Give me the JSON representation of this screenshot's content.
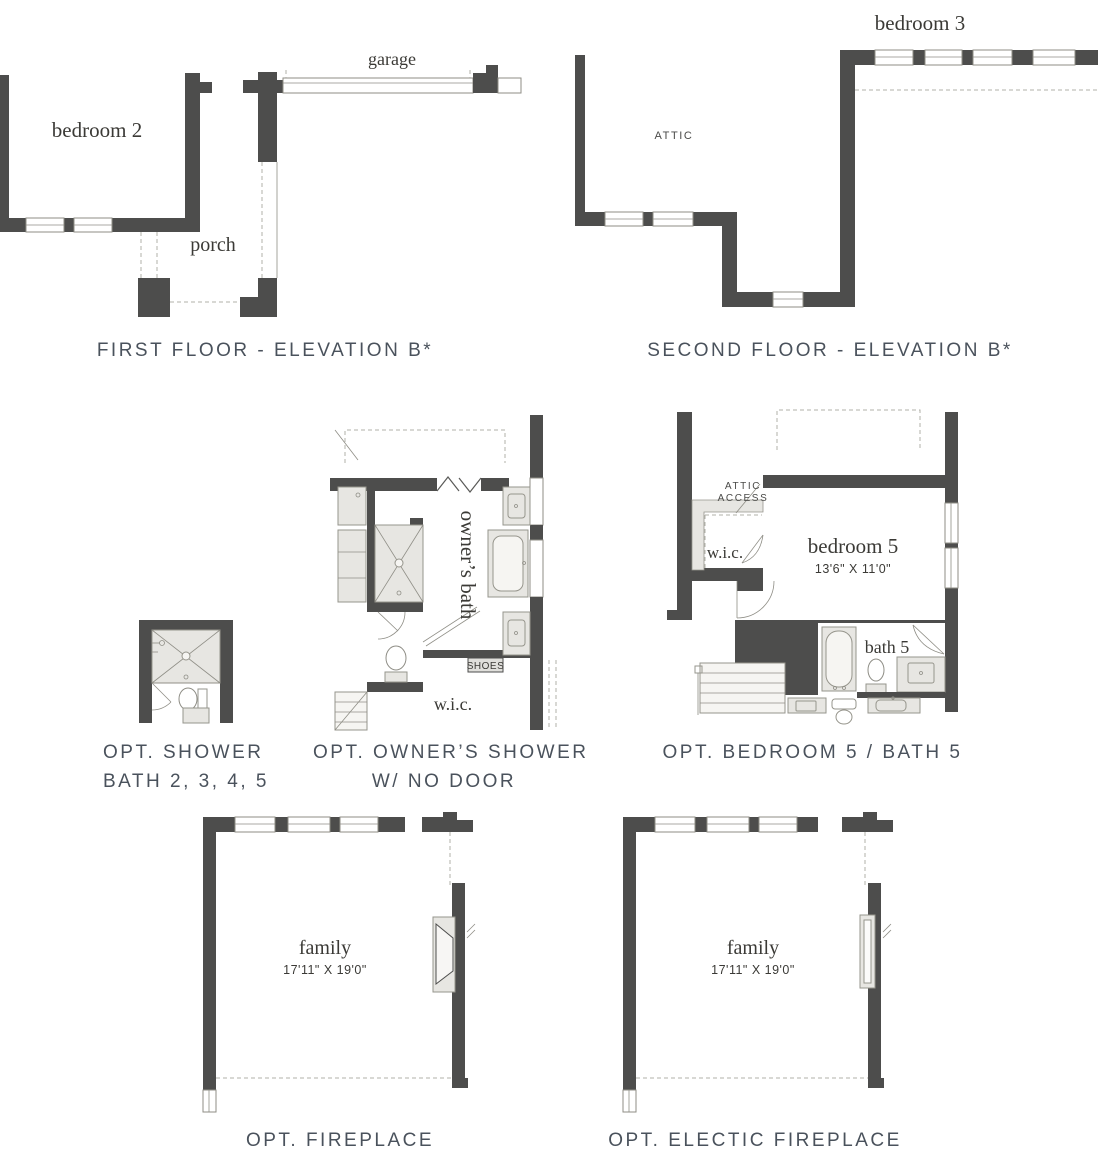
{
  "colors": {
    "wall": "#4d4d4c",
    "fixture_fill": "#e7e6e2",
    "fixture_stroke": "#96958c",
    "dashed_line": "#b2b1a9",
    "label_text": "#3b3a36",
    "title_text": "#4a525c",
    "background": "#ffffff"
  },
  "first_floor": {
    "title": "FIRST FLOOR - ELEVATION B*",
    "garage": "garage",
    "bedroom2": "bedroom 2",
    "porch": "porch"
  },
  "second_floor": {
    "title": "SECOND FLOOR - ELEVATION B*",
    "bedroom3": "bedroom 3",
    "attic": "ATTIC"
  },
  "opt_shower": {
    "title_line1": "OPT. SHOWER",
    "title_line2": "BATH 2, 3, 4, 5"
  },
  "opt_owners_shower": {
    "title_line1": "OPT. OWNER’S SHOWER",
    "title_line2": "W/ NO DOOR",
    "owners_bath": "owner’s bath",
    "wic": "w.i.c.",
    "shoes": "SHOES"
  },
  "opt_bedroom5": {
    "title": "OPT. BEDROOM 5 / BATH 5",
    "attic_access_line1": "ATTIC",
    "attic_access_line2": "ACCESS",
    "wic": "w.i.c.",
    "bedroom5": "bedroom 5",
    "bedroom5_dims": "13'6\" X 11'0\"",
    "bath5": "bath 5"
  },
  "opt_fireplace": {
    "title": "OPT. FIREPLACE",
    "family": "family",
    "family_dims": "17'11\" X 19'0\""
  },
  "opt_electric_fireplace": {
    "title": "OPT. ELECTIC FIREPLACE",
    "family": "family",
    "family_dims": "17'11\" X 19'0\""
  }
}
